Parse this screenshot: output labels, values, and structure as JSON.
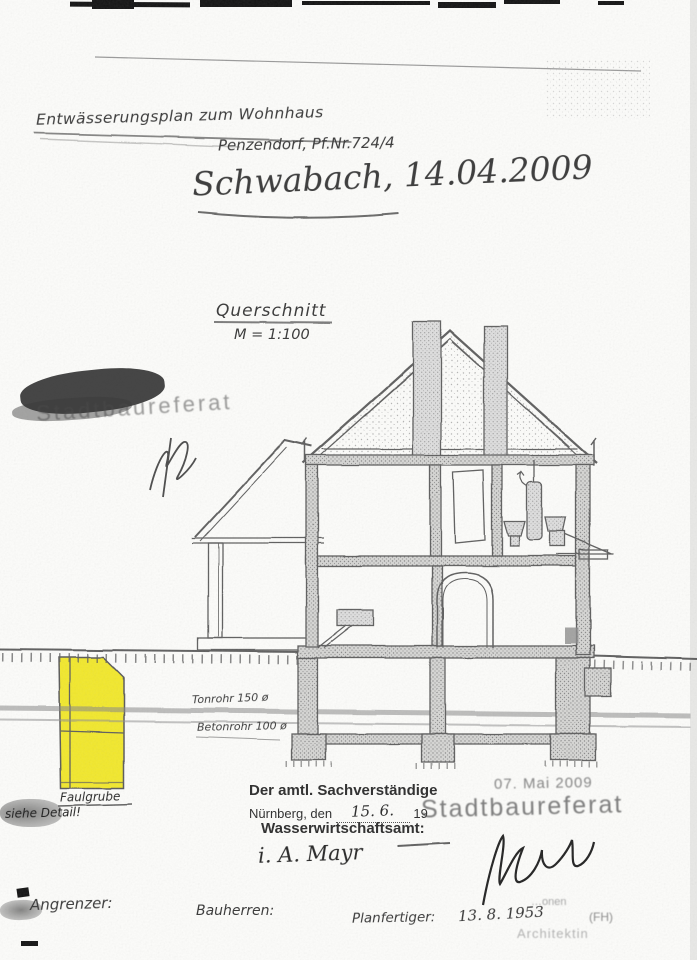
{
  "page": {
    "header": {
      "plan_title": "Entwässerungsplan zum Wohnhaus",
      "parcel": "Penzendorf,  Pf.Nr.724/4",
      "handwritten_place_date": "Schwabach, 14.04.2009"
    },
    "section": {
      "caption": "Querschnitt",
      "scale": "M = 1:100"
    },
    "stamp_top": {
      "number": "16.",
      "office": "Stadtbaureferat"
    },
    "drawing_labels": {
      "pipe_clay": "Tonrohr 150 ø",
      "pipe_concrete": "Betonrohr 100 ø",
      "septic_pit": "Faulgrube",
      "detail_note": "siehe Detail!"
    },
    "approval": {
      "expert_line": "Der amtl. Sachverständige",
      "city_prefix": "Nürnberg, den",
      "handwritten_date": "15. 6.",
      "year_suffix": "19",
      "office_line": "Wasserwirtschaftsamt:",
      "handwritten_initials": "i. A.  Mayr"
    },
    "stamp_bottom": {
      "date": "07. Mai 2009",
      "office": "Stadtbaureferat"
    },
    "signature_block": {
      "fragment": "…onen",
      "degree": "(FH)",
      "title": "Architektin"
    },
    "footer": {
      "neighbors": "Angrenzer:",
      "owners": "Bauherren:",
      "drafter": "Planfertiger:",
      "drafter_date": "13. 8. 1953"
    },
    "colors": {
      "highlight": "#f2e71e",
      "ink": "#3c3c3c",
      "stamp": "#6e6e6e"
    }
  }
}
